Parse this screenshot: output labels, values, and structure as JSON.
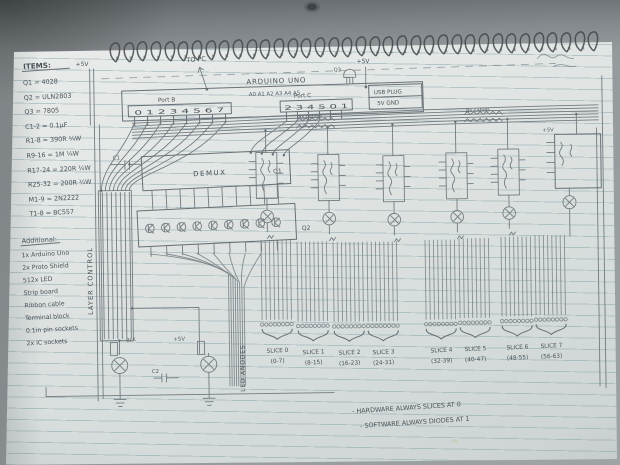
{
  "items": {
    "title": "ITEMS:",
    "list": [
      "Q1 = 4028",
      "Q2 = ULN2803",
      "Q3 = 7805",
      "C1-2 = 0.1µF",
      "R1-8 = 390R ¼W",
      "R9-16 = 1M ¼W",
      "R17-24 = 220R ¼W",
      "R25-32 = 200R ¼W",
      "M1-9 = 2N2222",
      "T1-8 = BC557"
    ]
  },
  "additional": {
    "title": "Additional:",
    "list": [
      "1x Arduino Uno",
      "2x Proto Shield",
      "512x LED",
      "Strip board",
      "Ribbon cable",
      "Terminal block",
      "0.1in pin sockets",
      "2x IC sockets"
    ]
  },
  "arduino": {
    "title": "ARDUINO UNO",
    "analog_pins": "A0 A1 A2 A3 A4 A5",
    "port_b_label": "Port B",
    "port_b_pins": "0 1 2 3 4 5 6 7",
    "port_c_label": "Port C",
    "port_c_pins": "2 3 4 5 0 1",
    "usb_line1": "USB PLUG",
    "usb_line2": "5V GND"
  },
  "labels": {
    "to_pc": "TO PC",
    "plus_5v": "+5V",
    "layer_control": "LAYER CONTROL",
    "led_anodes": "LED ANODES",
    "demux": "DEMUX",
    "q1": "Q1",
    "q2": "Q2",
    "q3": "Q3",
    "c1": "C1",
    "c2": "C2",
    "blk": "BLK",
    "cables": "8x cables"
  },
  "slices": [
    {
      "name": "SLICE 0",
      "range": "(0-7)"
    },
    {
      "name": "SLICE 1",
      "range": "(8-15)"
    },
    {
      "name": "SLICE 2",
      "range": "(16-23)"
    },
    {
      "name": "SLICE 3",
      "range": "(24-31)"
    },
    {
      "name": "SLICE 4",
      "range": "(32-39)"
    },
    {
      "name": "SLICE 5",
      "range": "(40-47)"
    },
    {
      "name": "SLICE 6",
      "range": "(48-55)"
    },
    {
      "name": "SLICE 7",
      "range": "(56-63)"
    }
  ],
  "notes": {
    "line1": "- HARDWARE ALWAYS SLICES AT 0",
    "line2": "- SOFTWARE ALWAYS DIODES AT 1"
  },
  "colors": {
    "paper": "#e3e7e6",
    "desk": "#8d9396",
    "pencil": "#747b80",
    "handwriting": "#4a5157",
    "rule_line": "#9fb4bb"
  }
}
